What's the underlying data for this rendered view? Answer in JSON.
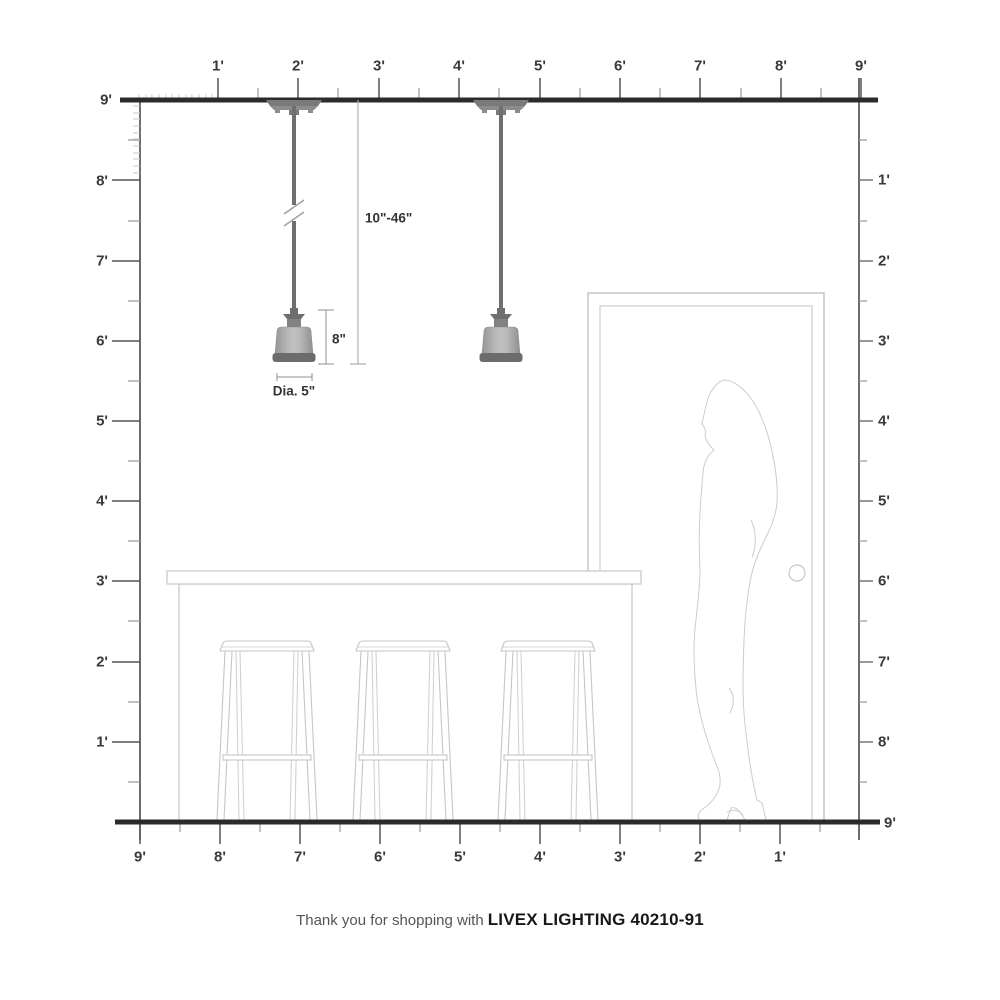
{
  "footer": {
    "prefix": "Thank you for shopping with",
    "product": "LIVEX LIGHTING 40210-91"
  },
  "annotations": {
    "hanging_height_range": "10\"-46\"",
    "fixture_height": "8\"",
    "fixture_diameter": "Dia. 5\""
  },
  "rulers": {
    "top": {
      "labels": [
        "1'",
        "2'",
        "3'",
        "4'",
        "5'",
        "6'",
        "7'",
        "8'",
        "9'"
      ]
    },
    "left": {
      "labels": [
        "9'",
        "8'",
        "7'",
        "6'",
        "5'",
        "4'",
        "3'",
        "2'",
        "1'"
      ]
    },
    "right": {
      "labels": [
        "1'",
        "2'",
        "3'",
        "4'",
        "5'",
        "6'",
        "7'",
        "8'",
        "9'"
      ]
    },
    "bottom": {
      "labels": [
        "9'",
        "8'",
        "7'",
        "6'",
        "5'",
        "4'",
        "3'",
        "2'",
        "1'"
      ]
    }
  },
  "colors": {
    "structure_line": "#2b2b2b",
    "ruler_text": "#3a3a3a",
    "fixture_gray": "#a6a6a6",
    "fixture_dark": "#6e6e6e",
    "furniture_outline": "#c6c6c6"
  }
}
